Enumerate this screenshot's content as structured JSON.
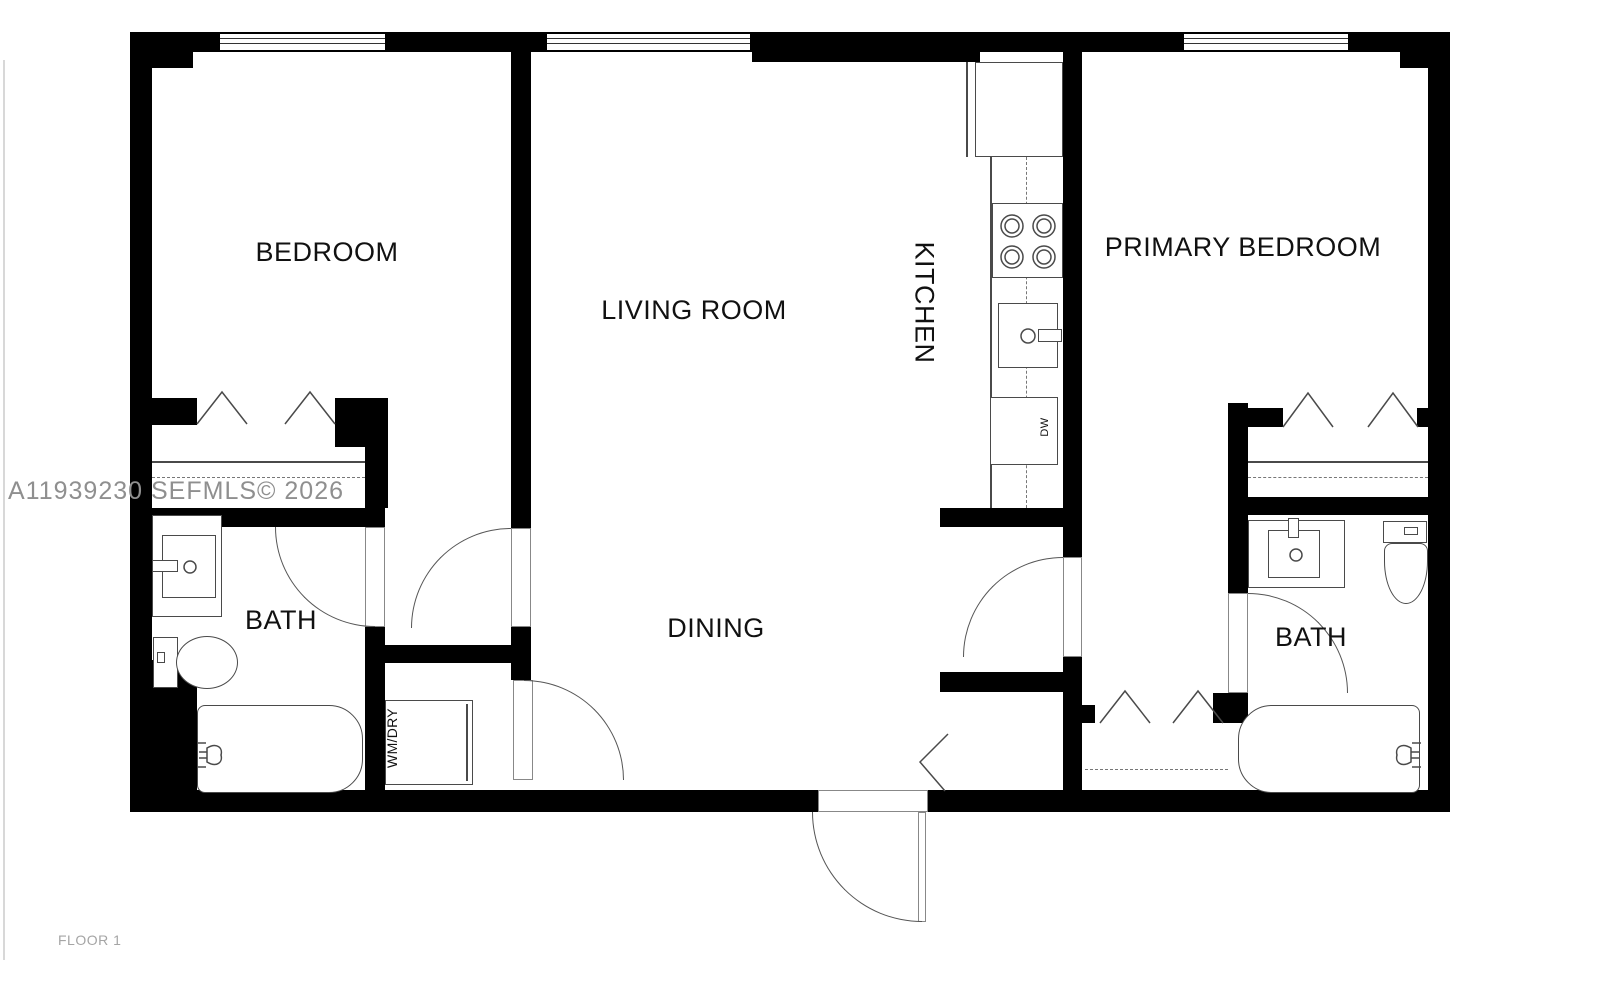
{
  "meta": {
    "watermark": "A11939230 SEFMLS© 2026",
    "floor_label": "FLOOR 1"
  },
  "rooms": {
    "bedroom": "BEDROOM",
    "living": "LIVING ROOM",
    "kitchen": "KITCHEN",
    "primary_bedroom": "PRIMARY BEDROOM",
    "bath_left": "BATH",
    "bath_right": "BATH",
    "dining": "DINING",
    "laundry": "WM/DRY",
    "dishwasher": "DW"
  },
  "fixtures": {
    "icons": [
      "fridge-icon",
      "stove-icon",
      "kitchen-sink-icon",
      "dishwasher-icon",
      "bathroom-sink-icon",
      "toilet-icon",
      "bathtub-icon",
      "washer-dryer-icon",
      "closet-rod",
      "door-swing",
      "window",
      "bifold-door-chevron"
    ]
  },
  "colors": {
    "wall": "#000000",
    "line": "#4a4a4a",
    "watermark": "#8f8f8f",
    "floor_text": "#a5a5a5",
    "background": "#ffffff"
  }
}
